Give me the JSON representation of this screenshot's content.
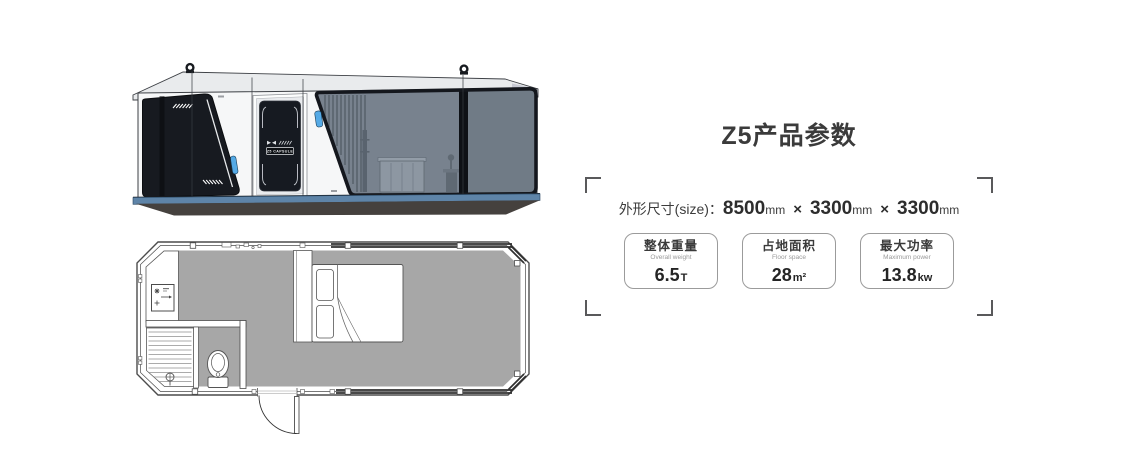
{
  "illustrations": {
    "elevation": {
      "alt": "Z5 capsule house side elevation rendering",
      "door_badge": "Z5 CAPSULE"
    },
    "floorplan": {
      "alt": "Z5 capsule house floor plan"
    }
  },
  "panel": {
    "title": "Z5产品参数",
    "size": {
      "label": "外形尺寸(size)：",
      "d1": "8500",
      "u1": "mm",
      "x1": "×",
      "d2": "3300",
      "u2": "mm",
      "x2": "×",
      "d3": "3300",
      "u3": "mm"
    },
    "specs": [
      {
        "cn": "整体重量",
        "en": "Overall weight",
        "value": "6.5",
        "unit": "T"
      },
      {
        "cn": "占地面积",
        "en": "Floor space",
        "value": "28",
        "unit": "m²"
      },
      {
        "cn": "最大功率",
        "en": "Maximum power",
        "value": "13.8",
        "unit": "kw"
      }
    ]
  },
  "colors": {
    "accent_stripe_blue": "#5e84a8",
    "handle_blue": "#55aae6",
    "glass_gray_blue": "#78828e",
    "dark_frame": "#14171d",
    "floor_gray": "#a7a7a7",
    "text_dark": "#3b3b3b",
    "text_muted": "#9a9a9a"
  }
}
